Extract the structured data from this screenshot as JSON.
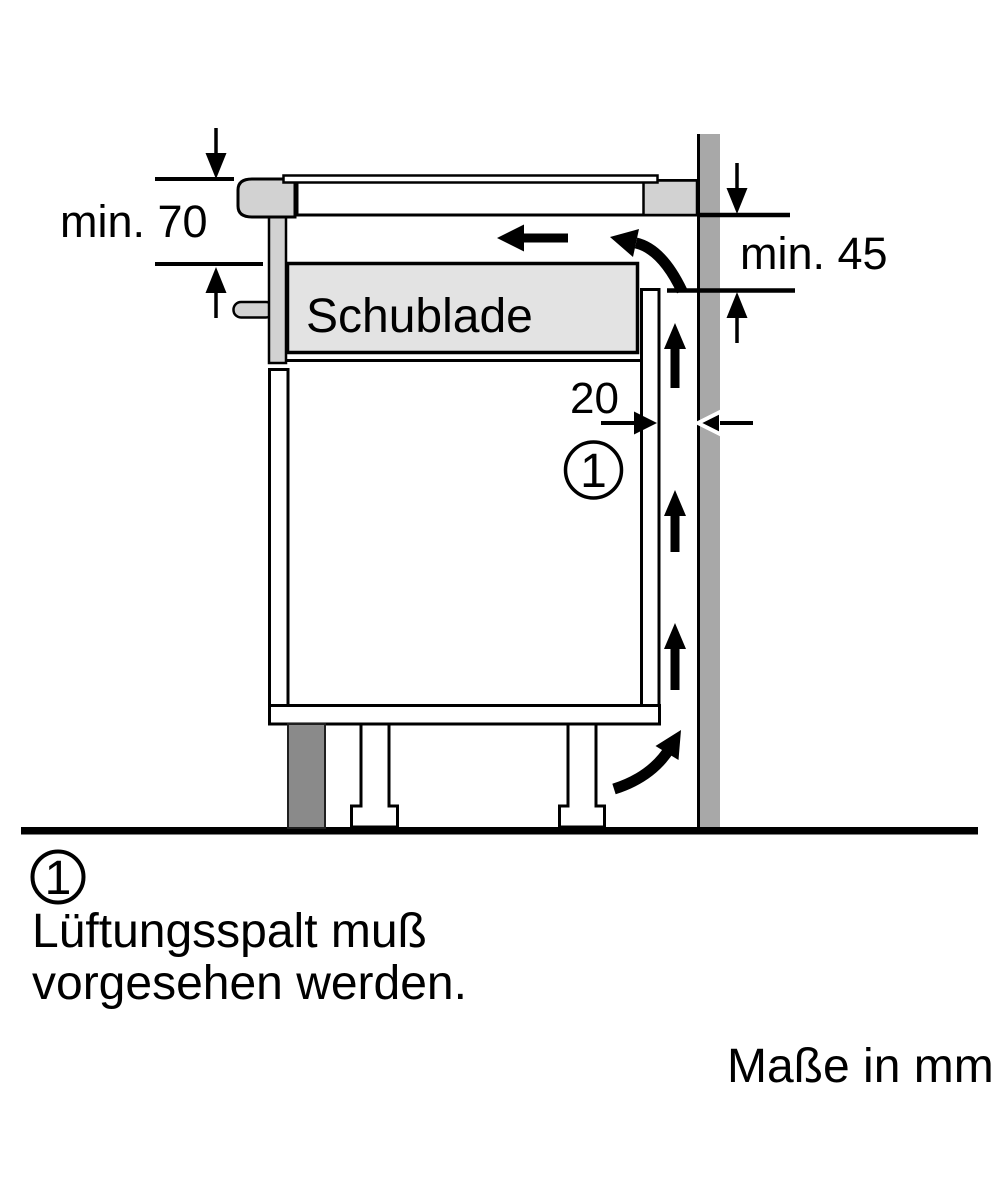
{
  "diagram": {
    "dimension_labels": {
      "left": "min. 70",
      "right": "min. 45",
      "gap": "20"
    },
    "drawer_label": "Schublade",
    "callout": {
      "number": "1"
    },
    "legend": {
      "number": "1",
      "text_line1": "Lüftungsspalt muß",
      "text_line2": "vorgesehen werden.",
      "units_note": "Maße in mm"
    },
    "colors": {
      "line": "#000000",
      "light_gray": "#d2d2d2",
      "drawer_fill": "#e3e3e3",
      "wall_gray": "#a8a8a8",
      "plinth_gray": "#8a8a8a",
      "white": "#ffffff"
    }
  }
}
